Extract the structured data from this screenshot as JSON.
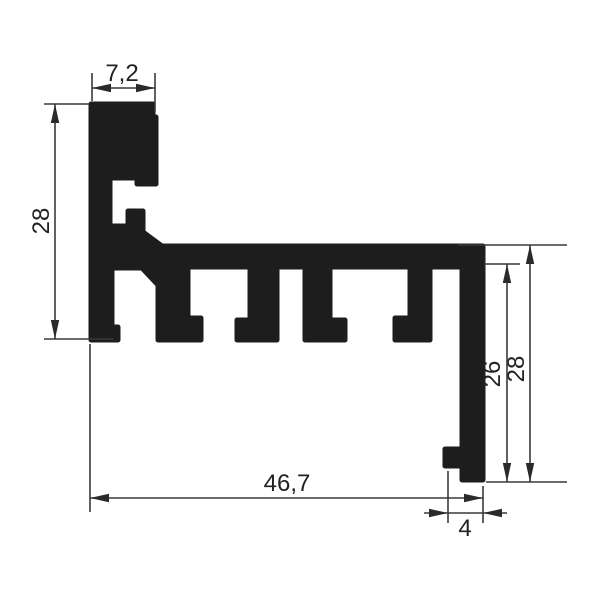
{
  "dimensions": {
    "top_width": "7,2",
    "left_height": "28",
    "bottom_width": "46,7",
    "leg_width": "4",
    "right_inner_height": "26",
    "right_outer_height": "28"
  },
  "colors": {
    "background": "#ffffff",
    "profile_fill": "#1d1d1d",
    "dimension_line": "#3a3a3a",
    "text": "#222222"
  }
}
